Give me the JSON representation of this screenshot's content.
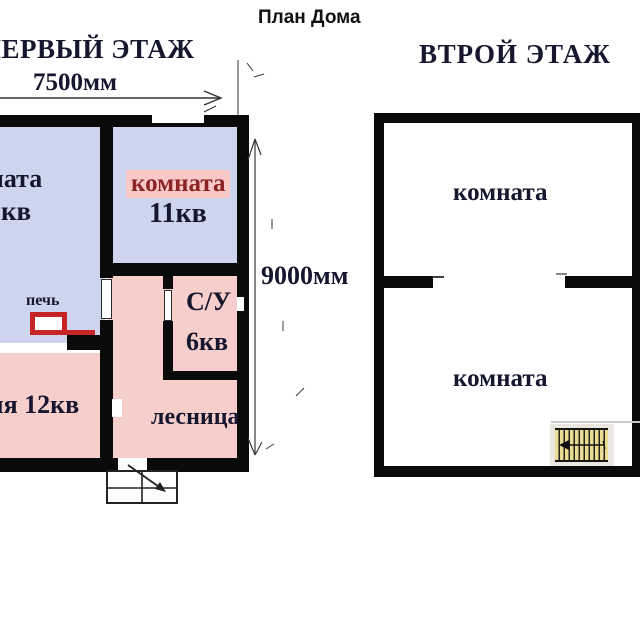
{
  "title": "План Дома",
  "colors": {
    "wall": "#0a0a0a",
    "room_blue": "#cdd4ee",
    "room_pink": "#f6cecb",
    "highlight_pink": "#fbc8c8",
    "stove_red": "#c72525",
    "text_dark": "#16162e",
    "text_maroon": "#8b2525",
    "stairs_yellow": "#eadb92"
  },
  "first_floor": {
    "heading": "ПЕРВЫЙ ЭТАЖ",
    "width_label": "7500мм",
    "height_label": "9000мм",
    "living_room": {
      "name": "комната",
      "area": "кв"
    },
    "room_11": {
      "name": "комната",
      "area": "11кв"
    },
    "kitchen_label": "кухня 12кв",
    "bathroom": {
      "name": "С/У",
      "area": "6кв"
    },
    "stairs_label": "лесница",
    "stove_label": "печь"
  },
  "second_floor": {
    "heading": "ВТРОЙ ЭТАЖ",
    "room_top": "комната",
    "room_bottom": "комната"
  }
}
